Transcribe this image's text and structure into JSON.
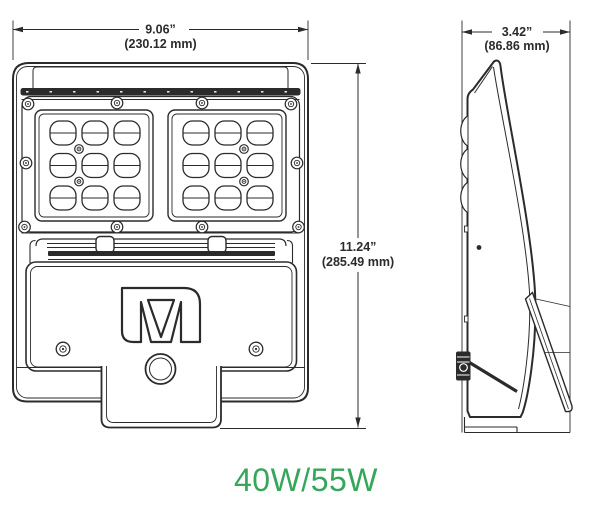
{
  "front_view": {
    "width_in": "9.06”",
    "width_mm": "(230.12 mm)",
    "height_in": "11.24”",
    "height_mm": "(285.49 mm)",
    "module_count": 2,
    "lenses_per_module": 9,
    "logo_letter": "M"
  },
  "side_view": {
    "depth_in": "3.42”",
    "depth_mm": "(86.86 mm)"
  },
  "footer": {
    "wattage": "40W/55W"
  },
  "colors": {
    "line": "#2b2b2b",
    "green": "#36a65a",
    "paper": "#ffffff"
  }
}
